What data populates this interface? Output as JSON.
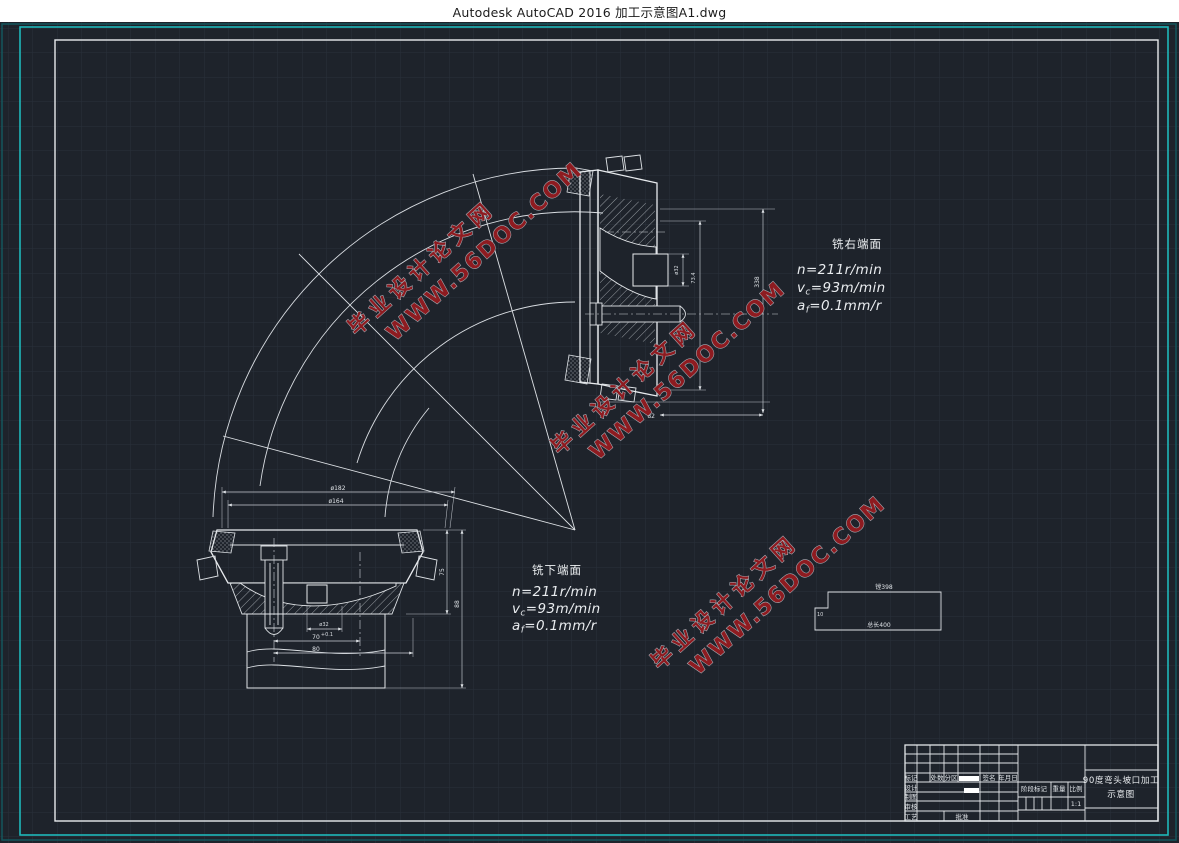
{
  "window_title": "Autodesk AutoCAD 2016    加工示意图A1.dwg",
  "colors": {
    "canvas_bg": "#1e232b",
    "grid": "#29303b",
    "frame_cyan": "#1fb8ba",
    "line_white": "#e8ebee",
    "watermark_red": "#8e1b20"
  },
  "watermark": {
    "line1": "毕业设计论文网",
    "line2": "WWW.56DOC.COM"
  },
  "annotations": {
    "right_face": {
      "label": "铣右端面",
      "n": "n=211r/min",
      "v_main": "v",
      "v_sub": "c",
      "v_rest": "=93m/min",
      "a_main": "a",
      "a_sub": "f",
      "a_rest": "=0.1mm/r"
    },
    "lower_face": {
      "label": "铣下端面",
      "n": "n=211r/min",
      "v_main": "v",
      "v_sub": "c",
      "v_rest": "=93m/min",
      "a_main": "a",
      "a_sub": "f",
      "a_rest": "=0.1mm/r"
    }
  },
  "dimensions": {
    "right_view": {
      "height": "338",
      "width": "82",
      "tool": "ø32",
      "depth": "73.4"
    },
    "lower_view": {
      "outer": "ø182",
      "pitch": "ø164",
      "h1": "75",
      "h2": "88",
      "bore": "ø32",
      "len": "70",
      "len_tol": "+0.1",
      "base": "80"
    }
  },
  "boring_sketch": {
    "top_label": "镗398",
    "bottom_label": "总长400",
    "left_label": "10"
  },
  "title_block": {
    "header": {
      "mark": "标记",
      "count": "处数",
      "zone": "分区",
      "sign": "签名",
      "date": "年月日"
    },
    "rows": {
      "design": "设计",
      "draft": "制图",
      "check": "审核",
      "process": "工艺",
      "approve": "批准"
    },
    "stage": "阶段标记",
    "weight": "重量",
    "scale": "比例",
    "scale_value": "1:1",
    "title_line1": "90度弯头坡口加工",
    "title_line2": "示意图"
  }
}
